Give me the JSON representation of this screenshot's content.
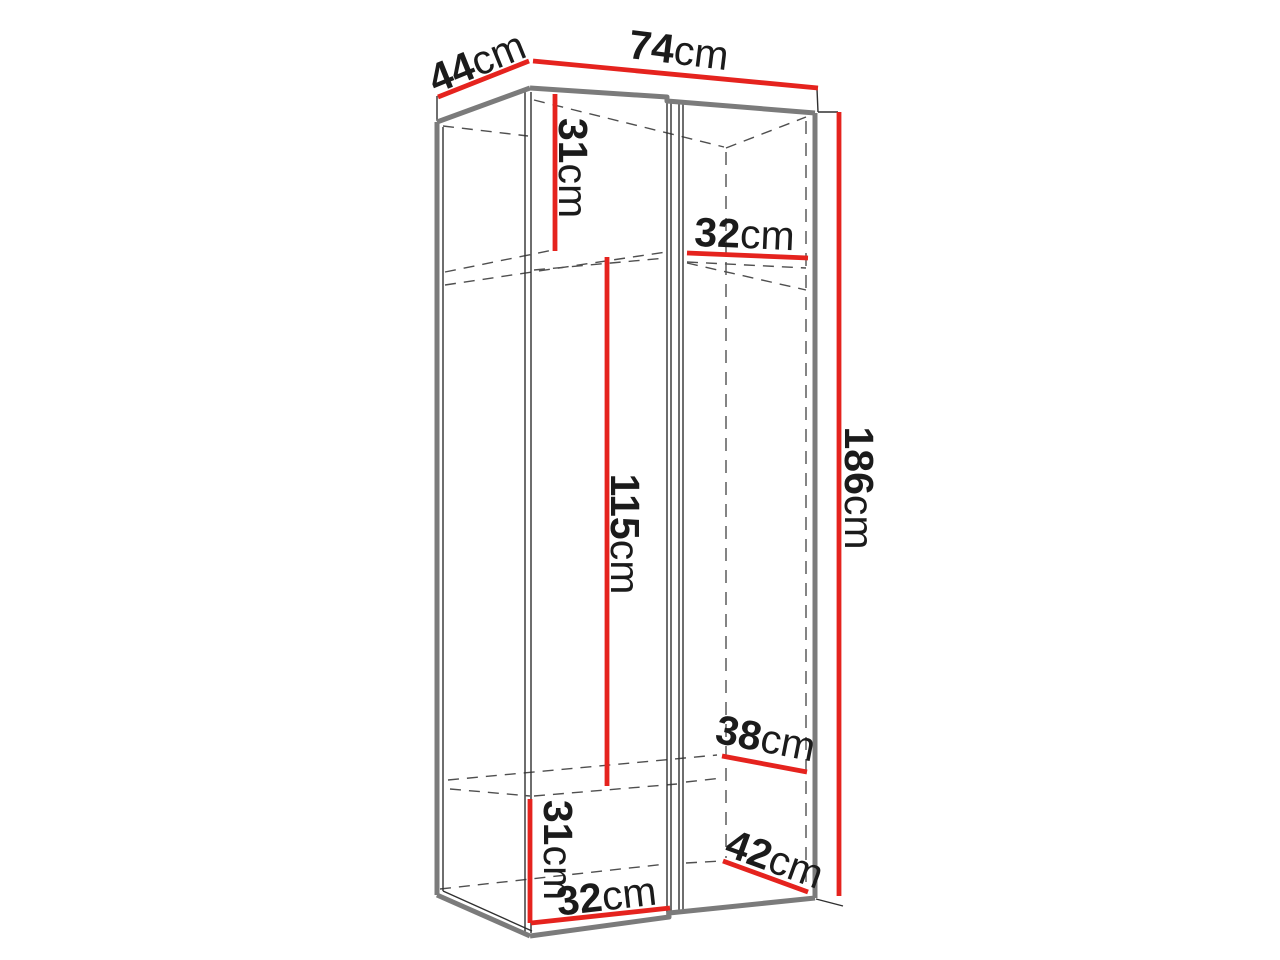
{
  "diagram": {
    "subject": "wardrobe-dimension-drawing",
    "unit": "cm",
    "labels": {
      "depth": {
        "value": "44",
        "unit": "cm"
      },
      "width": {
        "value": "74",
        "unit": "cm"
      },
      "top_section_height": {
        "value": "31",
        "unit": "cm"
      },
      "top_shelf_width": {
        "value": "32",
        "unit": "cm"
      },
      "middle_section_height": {
        "value": "115",
        "unit": "cm"
      },
      "overall_height": {
        "value": "186",
        "unit": "cm"
      },
      "bottom_shelf_depth": {
        "value": "38",
        "unit": "cm"
      },
      "bottom_section_height": {
        "value": "31",
        "unit": "cm"
      },
      "bottom_compartment_depth": {
        "value": "42",
        "unit": "cm"
      },
      "bottom_shelf_width": {
        "value": "32",
        "unit": "cm"
      }
    },
    "colors": {
      "dimension_line": "#e5231e",
      "edge": "#7b7b7b",
      "front_edge": "#303030",
      "hidden_edge": "#4f4f4f",
      "label": "#1b1b1b",
      "background": "#ffffff"
    }
  }
}
